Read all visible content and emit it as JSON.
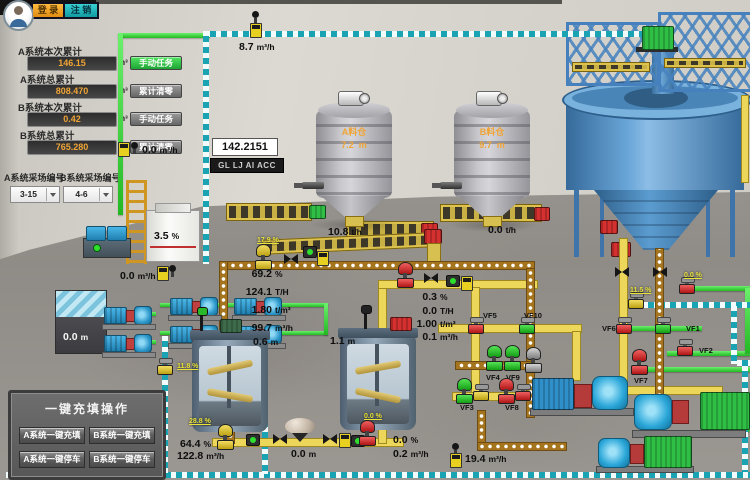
{
  "auth": {
    "login": "登 录",
    "logout": "注 销"
  },
  "totals": {
    "fields": [
      {
        "label": "A系统本次累计",
        "value": "146.15",
        "unit": "m³",
        "action": "手动任务"
      },
      {
        "label": "A系统总累计",
        "value": "808.470",
        "unit": "m³",
        "action": "累计清零"
      },
      {
        "label": "B系统本次累计",
        "value": "0.42",
        "unit": "m³",
        "action": "手动任务"
      },
      {
        "label": "B系统总累计",
        "value": "765.280",
        "unit": "m³",
        "action": "累计清零"
      }
    ],
    "site_selectors": [
      {
        "label": "A系统采场编号",
        "value": "3-15"
      },
      {
        "label": "B系统采场编号",
        "value": "4-6"
      }
    ]
  },
  "displays": {
    "flow_total": "142.2151",
    "tag": "GL LJ AI ACC"
  },
  "flows": {
    "top_pipe": {
      "v": "8.7",
      "u": "m³/h"
    },
    "left_pipe": {
      "v": "0.0",
      "u": "m³/h"
    },
    "pump_station": {
      "v": "0.0",
      "u": "m³/h"
    },
    "white_tank": {
      "v": "3.5",
      "u": "%"
    },
    "pool": {
      "v": "0.0",
      "u": "m"
    },
    "tank1": {
      "v": "0.6",
      "u": "m"
    },
    "tank2": {
      "v": "1.1",
      "u": "m"
    },
    "underflow_conc": {
      "v": "64.4",
      "u": "%"
    },
    "underflow_flow": {
      "v": "122.8",
      "u": "m³/h"
    },
    "hopper": {
      "v": "0.0",
      "u": "m"
    },
    "drain": {
      "v": "19.4",
      "u": "m³/h"
    }
  },
  "line_a": [
    {
      "v": "69.2",
      "u": "%"
    },
    {
      "v": "124.1",
      "u": "T/H"
    },
    {
      "v": "1.80",
      "u": "t/m³"
    },
    {
      "v": "99.7",
      "u": "m³/h"
    }
  ],
  "line_b": [
    {
      "v": "0.3",
      "u": "%"
    },
    {
      "v": "0.0",
      "u": "T/H"
    },
    {
      "v": "1.00",
      "u": "t/m³"
    },
    {
      "v": "0.1",
      "u": "m³/h"
    }
  ],
  "line_c": [
    {
      "v": "0.0",
      "u": "%"
    },
    {
      "v": "0.2",
      "u": "m³/h"
    }
  ],
  "silos": [
    {
      "name": "A料仓",
      "level": "7.2",
      "level_u": "m",
      "rate": "10.8",
      "rate_u": "t/h"
    },
    {
      "name": "B料仓",
      "level": "9.7",
      "level_u": "m",
      "rate": "0.0",
      "rate_u": "t/h"
    }
  ],
  "valve_openings": [
    "17.9 %",
    "11.8 %",
    "28.8 %",
    "0.0 %",
    "0.0 %",
    "11.5 %"
  ],
  "vf": [
    "VF1",
    "VF2",
    "VF3",
    "VF4",
    "VF5",
    "VF6",
    "VF7",
    "VF8",
    "VF9",
    "VF10"
  ],
  "fill_panel": {
    "title": "一键充填操作",
    "buttons": [
      "A系统一键充填",
      "B系统一键充填",
      "A系统一键停车",
      "B系统一键停车"
    ]
  },
  "colors": {
    "pipe_slurry": "#a5741f",
    "pipe_water": "#1aa3b2",
    "pipe_fill": "#ecd75b",
    "pipe_clear": "#35d93a",
    "value_accent": "#f0a435",
    "valve_open_green": "#22c122",
    "valve_closed_red": "#d02020",
    "button_login": "#f0a020",
    "button_logout": "#18b2b8"
  }
}
